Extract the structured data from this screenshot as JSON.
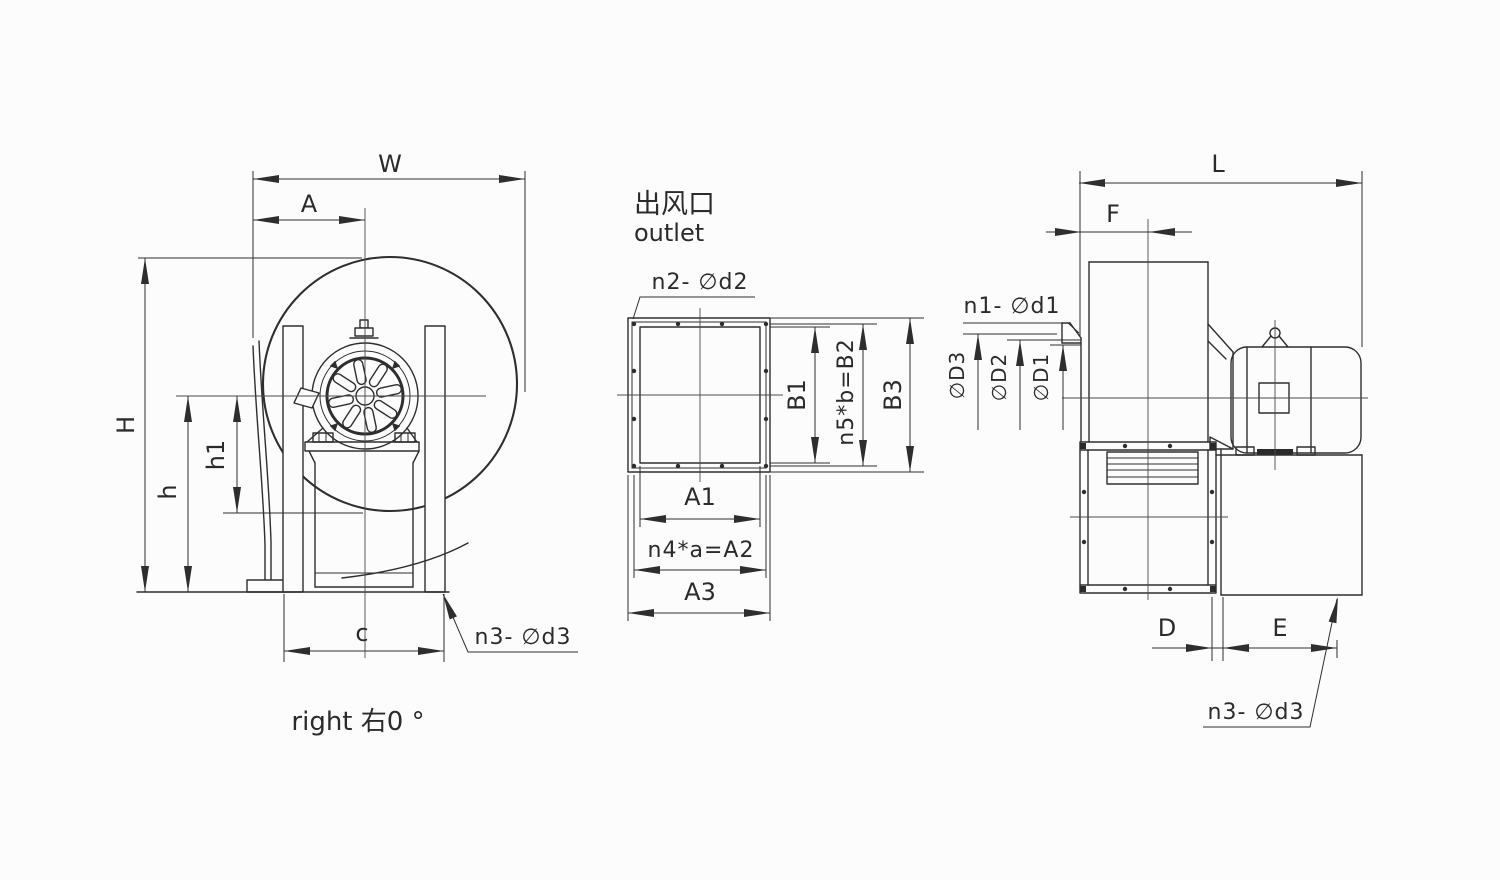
{
  "colors": {
    "background": "#fcfcfc",
    "line": "#2e2e2e",
    "text": "#2b2b2b"
  },
  "left_view": {
    "dim_w": "W",
    "dim_a": "A",
    "dim_h_total": "H",
    "dim_h_axis": "h",
    "dim_h1": "h1",
    "dim_c": "c",
    "callout_feet_holes": "n3- ∅d3",
    "caption": "right 右0 °"
  },
  "outlet_view": {
    "title_cn": "出风口",
    "title_en": "outlet",
    "callout_flange_holes": "n2- ∅d2",
    "dim_b1": "B1",
    "dim_b2": "n5*b=B2",
    "dim_b3": "B3",
    "dim_a1": "A1",
    "dim_a2": "n4*a=A2",
    "dim_a3": "A3"
  },
  "side_view": {
    "dim_l": "L",
    "dim_f": "F",
    "dim_d": "D",
    "dim_e": "E",
    "dim_inlet_d3": "∅D3",
    "dim_inlet_d2": "∅D2",
    "dim_inlet_d1": "∅D1",
    "callout_inlet_holes": "n1- ∅d1",
    "callout_base_holes": "n3- ∅d3"
  }
}
